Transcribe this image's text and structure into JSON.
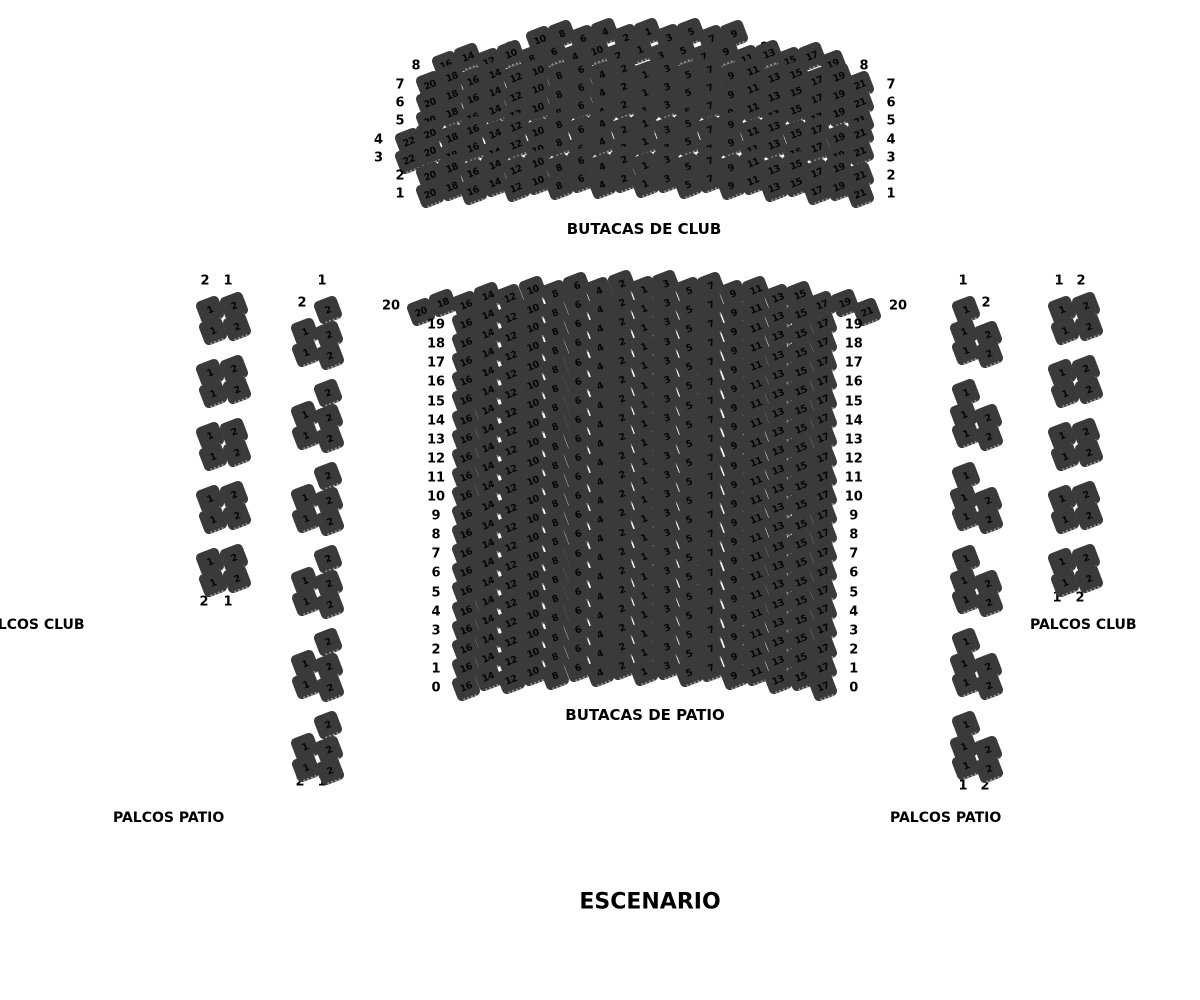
{
  "colors": {
    "seat": "#3a3a3a",
    "seat_text": "#050505",
    "label_text": "#000000",
    "background": "#ffffff"
  },
  "stage": {
    "label": "ESCENARIO"
  },
  "sections": {
    "club": {
      "label": "BUTACAS DE CLUB",
      "rows": [
        {
          "label": "9",
          "seats": [
            10,
            8,
            6,
            4,
            2,
            1,
            3,
            5,
            7,
            9
          ]
        },
        {
          "label": "8",
          "seats": [
            16,
            14,
            12,
            10,
            8,
            6,
            4,
            10,
            2,
            1,
            3,
            5,
            7,
            9,
            11,
            13,
            15,
            17,
            19
          ]
        },
        {
          "label": "7",
          "seats": [
            20,
            18,
            16,
            14,
            12,
            10,
            8,
            6,
            4,
            2,
            1,
            3,
            5,
            7,
            9,
            11,
            13,
            15,
            17,
            19,
            21
          ]
        },
        {
          "label": "6",
          "seats": [
            20,
            18,
            16,
            14,
            12,
            10,
            8,
            6,
            4,
            2,
            1,
            3,
            5,
            7,
            9,
            11,
            13,
            15,
            17,
            19,
            21
          ]
        },
        {
          "label": "5",
          "seats": [
            20,
            18,
            16,
            14,
            12,
            10,
            8,
            6,
            4,
            2,
            1,
            3,
            5,
            7,
            9,
            11,
            13,
            15,
            17,
            19,
            21
          ]
        },
        {
          "label": "4",
          "seats": [
            22,
            20,
            18,
            16,
            14,
            12,
            10,
            8,
            6,
            4,
            2,
            1,
            3,
            5,
            7,
            9,
            11,
            13,
            15,
            17,
            19,
            21
          ]
        },
        {
          "label": "3",
          "seats": [
            22,
            20,
            18,
            16,
            14,
            12,
            10,
            8,
            6,
            4,
            2,
            1,
            3,
            5,
            7,
            9,
            11,
            13,
            15,
            17,
            19,
            21
          ]
        },
        {
          "label": "2",
          "seats": [
            20,
            18,
            16,
            14,
            12,
            10,
            8,
            6,
            4,
            2,
            1,
            3,
            5,
            7,
            9,
            11,
            13,
            15,
            17,
            19,
            21
          ]
        },
        {
          "label": "1",
          "seats": [
            20,
            18,
            16,
            14,
            12,
            10,
            8,
            6,
            4,
            2,
            1,
            3,
            5,
            7,
            9,
            11,
            13,
            15,
            17,
            19,
            21
          ]
        }
      ]
    },
    "patio": {
      "label": "BUTACAS DE PATIO",
      "rows": [
        {
          "label": "20",
          "seats": [
            20,
            18,
            16,
            14,
            12,
            10,
            8,
            6,
            4,
            2,
            1,
            3,
            5,
            7,
            9,
            11,
            13,
            15,
            17,
            19,
            21
          ]
        },
        {
          "label": "19",
          "seats": [
            16,
            14,
            12,
            10,
            8,
            6,
            4,
            2,
            1,
            3,
            5,
            7,
            9,
            11,
            13,
            15,
            17
          ]
        },
        {
          "label": "18",
          "seats": [
            16,
            14,
            12,
            10,
            8,
            6,
            4,
            2,
            1,
            3,
            5,
            7,
            9,
            11,
            13,
            15,
            17
          ]
        },
        {
          "label": "17",
          "seats": [
            16,
            14,
            12,
            10,
            8,
            6,
            4,
            2,
            1,
            3,
            5,
            7,
            9,
            11,
            13,
            15,
            17
          ]
        },
        {
          "label": "16",
          "seats": [
            16,
            14,
            12,
            10,
            8,
            6,
            4,
            2,
            1,
            3,
            5,
            7,
            9,
            11,
            13,
            15,
            17
          ]
        },
        {
          "label": "15",
          "seats": [
            16,
            14,
            12,
            10,
            8,
            6,
            4,
            2,
            1,
            3,
            5,
            7,
            9,
            11,
            13,
            15,
            17
          ]
        },
        {
          "label": "14",
          "seats": [
            16,
            14,
            12,
            10,
            8,
            6,
            4,
            2,
            1,
            3,
            5,
            7,
            9,
            11,
            13,
            15,
            17
          ]
        },
        {
          "label": "13",
          "seats": [
            16,
            14,
            12,
            10,
            8,
            6,
            4,
            2,
            1,
            3,
            5,
            7,
            9,
            11,
            13,
            15,
            17
          ]
        },
        {
          "label": "12",
          "seats": [
            16,
            14,
            12,
            10,
            8,
            6,
            4,
            2,
            1,
            3,
            5,
            7,
            9,
            11,
            13,
            15,
            17
          ]
        },
        {
          "label": "11",
          "seats": [
            16,
            14,
            12,
            10,
            8,
            6,
            4,
            2,
            1,
            3,
            5,
            7,
            9,
            11,
            13,
            15,
            17
          ]
        },
        {
          "label": "10",
          "seats": [
            16,
            14,
            12,
            10,
            8,
            6,
            4,
            2,
            1,
            3,
            5,
            7,
            9,
            11,
            13,
            15,
            17
          ]
        },
        {
          "label": "9",
          "seats": [
            16,
            14,
            12,
            10,
            8,
            6,
            4,
            2,
            1,
            3,
            5,
            7,
            9,
            11,
            13,
            15,
            17
          ]
        },
        {
          "label": "8",
          "seats": [
            16,
            14,
            12,
            10,
            8,
            6,
            4,
            2,
            1,
            3,
            5,
            7,
            9,
            11,
            13,
            15,
            17
          ]
        },
        {
          "label": "7",
          "seats": [
            16,
            14,
            12,
            10,
            8,
            6,
            4,
            2,
            1,
            3,
            5,
            7,
            9,
            11,
            13,
            15,
            17
          ]
        },
        {
          "label": "6",
          "seats": [
            16,
            14,
            12,
            10,
            8,
            6,
            4,
            2,
            1,
            3,
            5,
            7,
            9,
            11,
            13,
            15,
            17
          ]
        },
        {
          "label": "5",
          "seats": [
            16,
            14,
            12,
            10,
            8,
            6,
            4,
            2,
            1,
            3,
            5,
            7,
            9,
            11,
            13,
            15,
            17
          ]
        },
        {
          "label": "4",
          "seats": [
            16,
            14,
            12,
            10,
            8,
            6,
            4,
            2,
            1,
            3,
            5,
            7,
            9,
            11,
            13,
            15,
            17
          ]
        },
        {
          "label": "3",
          "seats": [
            16,
            14,
            12,
            10,
            8,
            6,
            4,
            2,
            1,
            3,
            5,
            7,
            9,
            11,
            13,
            15,
            17
          ]
        },
        {
          "label": "2",
          "seats": [
            16,
            14,
            12,
            10,
            8,
            6,
            4,
            2,
            1,
            3,
            5,
            7,
            9,
            11,
            13,
            15,
            17
          ]
        },
        {
          "label": "1",
          "seats": [
            16,
            14,
            12,
            10,
            8,
            6,
            4,
            2,
            1,
            3,
            5,
            7,
            9,
            11,
            13,
            15,
            17
          ]
        },
        {
          "label": "0",
          "seats": [
            16,
            14,
            12,
            10,
            8,
            6,
            4,
            2,
            1,
            3,
            5,
            7,
            9,
            11,
            13,
            15,
            17
          ]
        }
      ]
    },
    "palcos": {
      "labels": {
        "club_left": "PALCOS CLUB",
        "club_right": "PALCOS CLUB",
        "patio_left": "PALCOS PATIO",
        "patio_right": "PALCOS PATIO"
      },
      "left_outer": {
        "header": [
          "2",
          "1"
        ],
        "footer": [
          "2",
          "1"
        ],
        "groups": [
          [
            1,
            2,
            1,
            2
          ],
          [
            1,
            2,
            1,
            2
          ],
          [
            1,
            2,
            1,
            2
          ],
          [
            1,
            2,
            1,
            2
          ],
          [
            1,
            2,
            1,
            2
          ]
        ]
      },
      "left_inner": {
        "header": [
          "1",
          "2"
        ],
        "footer": [
          "2",
          "1"
        ],
        "groups": [
          [
            2,
            1,
            2,
            1,
            2
          ],
          [
            2,
            1,
            2,
            1,
            2
          ],
          [
            2,
            1,
            2,
            1,
            2
          ],
          [
            2,
            1,
            2,
            1,
            2
          ],
          [
            2,
            1,
            2,
            1,
            2
          ],
          [
            2,
            1,
            2,
            1,
            2
          ]
        ]
      },
      "right_inner": {
        "header": [
          "1",
          "2"
        ],
        "footer": [
          "1",
          "2"
        ],
        "groups": [
          [
            1,
            1,
            2,
            1,
            2
          ],
          [
            1,
            1,
            2,
            1,
            2
          ],
          [
            1,
            1,
            2,
            1,
            2
          ],
          [
            1,
            1,
            2,
            1,
            2
          ],
          [
            1,
            1,
            2,
            1,
            2
          ],
          [
            1,
            1,
            2,
            1,
            2
          ]
        ]
      },
      "right_outer": {
        "header": [
          "1",
          "2"
        ],
        "footer": [
          "1",
          "2"
        ],
        "groups": [
          [
            1,
            2,
            1,
            2
          ],
          [
            1,
            2,
            1,
            2
          ],
          [
            1,
            2,
            1,
            2
          ],
          [
            1,
            2,
            1,
            2
          ],
          [
            1,
            2,
            1,
            2
          ]
        ]
      }
    }
  }
}
